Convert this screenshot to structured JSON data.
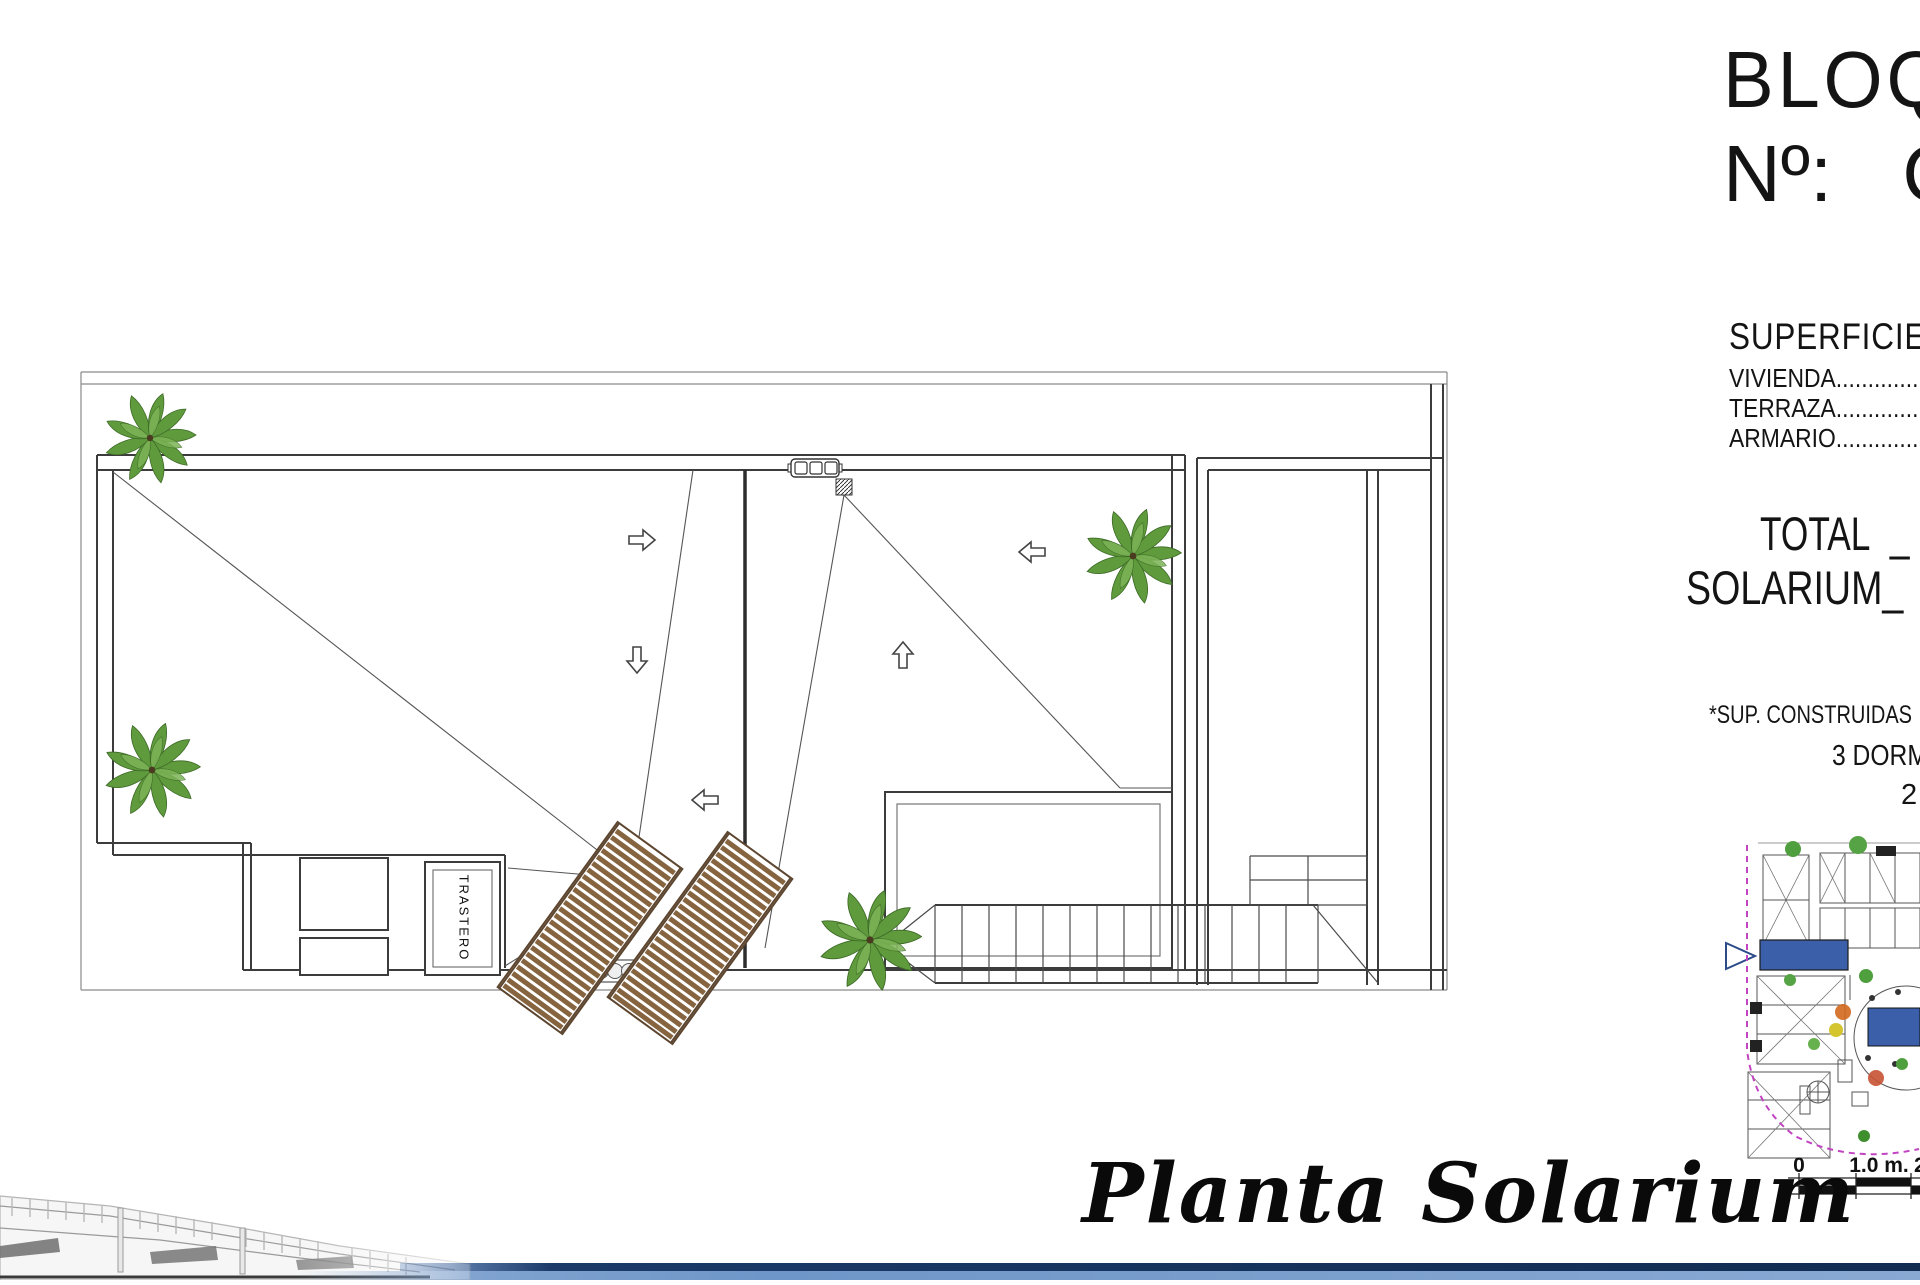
{
  "colors": {
    "palm_green": "#5f9b3c",
    "palm_green_light": "#7cb356",
    "lounger_brown": "#86643f",
    "highlight_blue": "#3b5fa9",
    "boundary_magenta": "#c244c2",
    "footer_navy": "#1b3a69",
    "footer_blue": "#8fafd9"
  },
  "title_block": {
    "block_label": "BLOQ",
    "number_label": "Nº:",
    "number_value": "C",
    "surfaces_heading": "SUPERFICIE",
    "rows": [
      {
        "label": "VIVIENDA",
        "dots": "......................"
      },
      {
        "label": "TERRAZA",
        "dots": "......................"
      },
      {
        "label": "ARMARIO",
        "dots": "......................"
      }
    ],
    "total_label": "TOTAL",
    "total_separator": "_",
    "total_value": "9",
    "solarium_label": "SOLARIUM_",
    "footnote": "*SUP. CONSTRUIDAS",
    "footnote_line2": "3 DORM",
    "footnote_line3": "2"
  },
  "plan": {
    "room_label": "TRASTERO",
    "caption": "Planta Solarium"
  },
  "scale_bar": {
    "labels": [
      "0",
      "1.0 m.",
      "2"
    ]
  }
}
